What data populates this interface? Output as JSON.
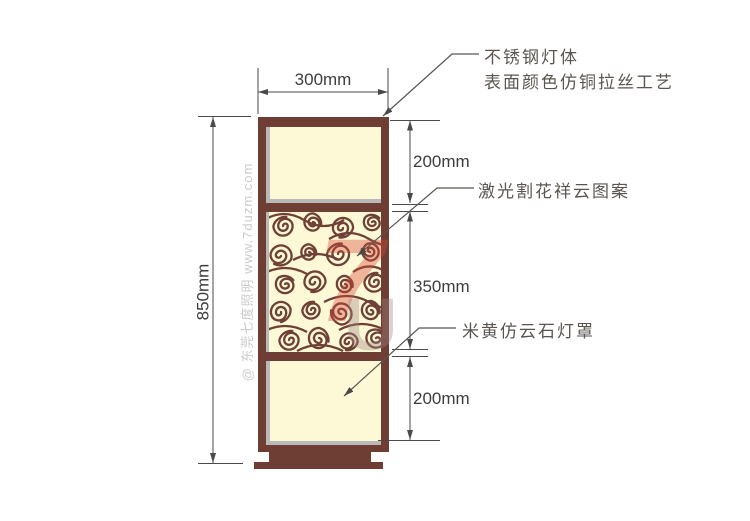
{
  "dimensions": {
    "width_top": "300mm",
    "height_total": "850mm",
    "section_top": "200mm",
    "section_middle": "350mm",
    "section_bottom": "200mm"
  },
  "annotations": {
    "body_line1": "不锈钢灯体",
    "body_line2": "表面颜色仿铜拉丝工艺",
    "pattern_label": "激光割花祥云图案",
    "shade_label": "米黄仿云石灯罩"
  },
  "watermark": {
    "side_text": "@ 东莞七度照明 www.7duzm.com",
    "logo_top": "7",
    "logo_bottom": "U"
  },
  "colors": {
    "frame_brown": "#6e3d33",
    "panel_cream": "#fdf8d6",
    "panel_gray": "#b9b9b9",
    "dimension_line": "#4a4a4a",
    "annotation_text": "#5a5550",
    "watermark_gray": "#cbcbcb",
    "watermark_red": "#d6463a"
  }
}
